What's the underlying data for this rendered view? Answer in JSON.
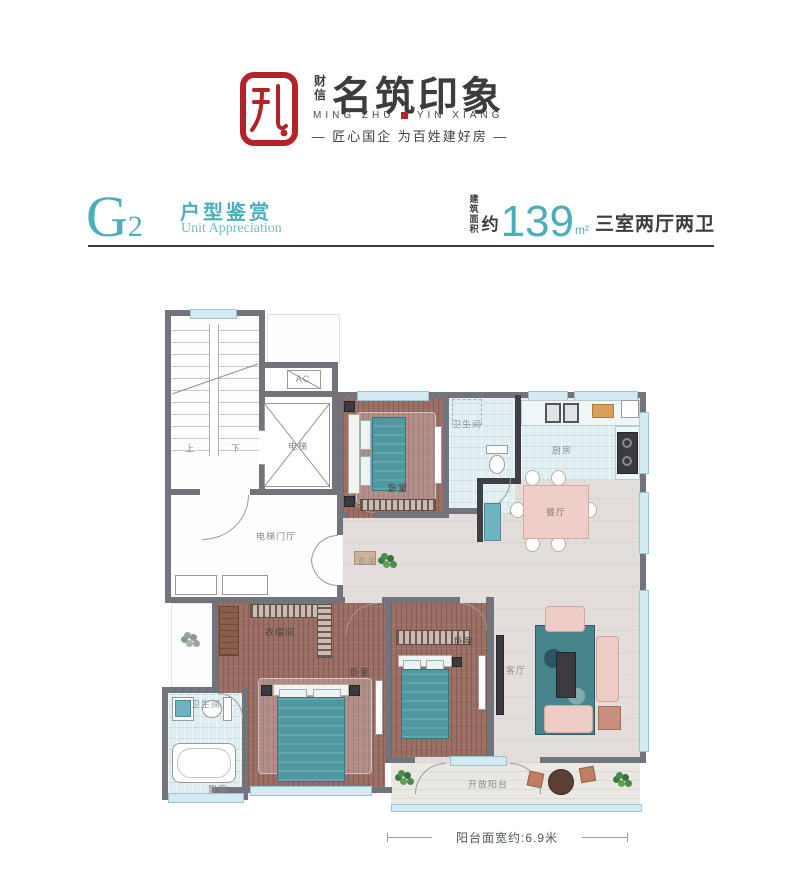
{
  "logo": {
    "brand_small": "财信",
    "brand_title": "名筑印象",
    "brand_latin_left": "MING ZHU",
    "brand_latin_right": "YIN XIANG",
    "tagline": "— 匠心国企 为百姓建好房 —"
  },
  "section": {
    "unit_code": "G",
    "unit_code_sub": "2",
    "title_cn": "户型鉴赏",
    "title_en": "Unit Appreciation",
    "area_label_line1": "建筑",
    "area_label_line2": "面积",
    "area_approx": "约",
    "area_value": "139",
    "area_unit": "m²",
    "layout_desc": "三室两厅两卫"
  },
  "colors": {
    "accent_teal": "#4aafb9",
    "brand_red": "#b2232a",
    "ink": "#3b3b3b",
    "wall_gray": "#73737b",
    "wall_dark": "#3f3f46",
    "wood_floor": "#9b6f66",
    "tile_floor": "#e0eef1",
    "marble_floor": "#e3dedb",
    "window_blue": "#d3eaf3"
  },
  "plan": {
    "labels": [
      {
        "name": "ac",
        "text": "AC",
        "x": 143,
        "y": 79,
        "tone": "gray"
      },
      {
        "name": "stair-up",
        "text": "上",
        "x": 30,
        "y": 148,
        "tone": "gray"
      },
      {
        "name": "stair-down",
        "text": "下",
        "x": 76,
        "y": 148,
        "tone": "gray"
      },
      {
        "name": "elevator",
        "text": "电梯",
        "x": 138,
        "y": 146,
        "tone": "gray"
      },
      {
        "name": "elevator-lobby",
        "text": "电梯门厅",
        "x": 116,
        "y": 236,
        "tone": "gray"
      },
      {
        "name": "bedroom-north",
        "text": "卧室",
        "x": 238,
        "y": 188,
        "tone": "wood"
      },
      {
        "name": "bath-north",
        "text": "卫生间",
        "x": 307,
        "y": 124,
        "tone": "tile"
      },
      {
        "name": "kitchen",
        "text": "厨房",
        "x": 402,
        "y": 150,
        "tone": "tile"
      },
      {
        "name": "dining",
        "text": "餐厅",
        "x": 396,
        "y": 212,
        "tone": "pink"
      },
      {
        "name": "foyer",
        "text": "玄关",
        "x": 207,
        "y": 261,
        "tone": "marble"
      },
      {
        "name": "living",
        "text": "客厅",
        "x": 356,
        "y": 370,
        "tone": "marble"
      },
      {
        "name": "cloakroom",
        "text": "衣帽间",
        "x": 120,
        "y": 332,
        "tone": "wood"
      },
      {
        "name": "bedroom-master",
        "text": "卧室",
        "x": 200,
        "y": 372,
        "tone": "wood"
      },
      {
        "name": "bedroom-second",
        "text": "卧室",
        "x": 304,
        "y": 341,
        "tone": "wood"
      },
      {
        "name": "bath-south",
        "text": "卫生间",
        "x": 46,
        "y": 404,
        "tone": "tile"
      },
      {
        "name": "bay-window",
        "text": "飘窗",
        "x": 58,
        "y": 489,
        "tone": "gray"
      },
      {
        "name": "balcony",
        "text": "开放阳台",
        "x": 328,
        "y": 484,
        "tone": "gray"
      }
    ],
    "dimension": {
      "text": "阳台面宽约:6.9米"
    }
  }
}
